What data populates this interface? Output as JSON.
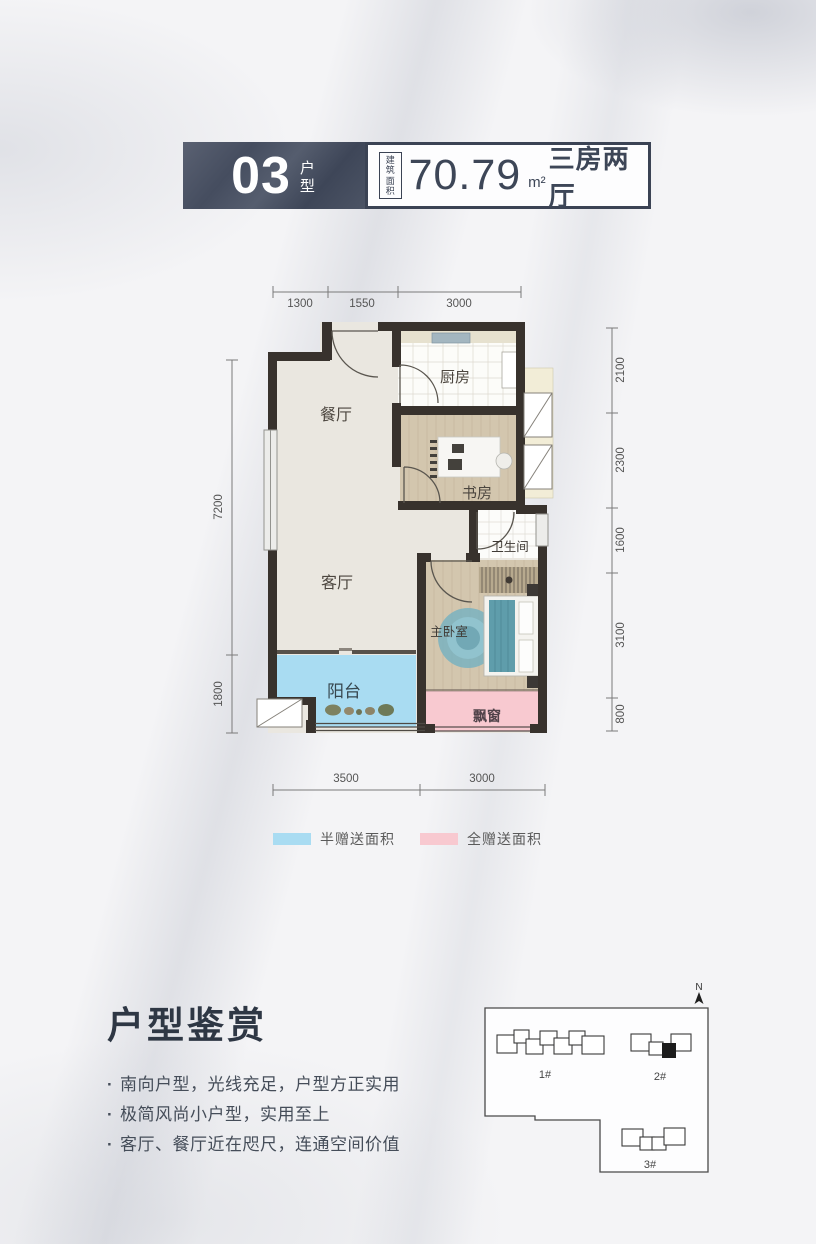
{
  "header": {
    "unit_number": "03",
    "unit_type": "户型",
    "area_label_1": "建筑",
    "area_label_2": "面积",
    "area_value": "70.79",
    "area_unit": "m²",
    "layout_type": "三房两厅"
  },
  "floorplan": {
    "rooms": {
      "dining": "餐厅",
      "kitchen": "厨房",
      "study": "书房",
      "bathroom": "卫生间",
      "living": "客厅",
      "master_bedroom": "主卧室",
      "balcony": "阳台",
      "bay_window": "飘窗"
    },
    "dims_top": [
      "1300",
      "1550",
      "3000"
    ],
    "dims_bottom": [
      "3500",
      "3000"
    ],
    "dims_left": [
      "7200",
      "1800"
    ],
    "dims_right": [
      "2100",
      "2300",
      "1600",
      "3100",
      "800"
    ],
    "colors": {
      "half_gift": "#a9dcf2",
      "full_gift": "#f8c9d0",
      "wall": "#38322d",
      "header_dark": "#4a5263",
      "text_dark": "#3d4657"
    }
  },
  "legend": {
    "half_gift": "半赠送面积",
    "full_gift": "全赠送面积"
  },
  "appreciation": {
    "title": "户型鉴赏",
    "bullet_marker": "·",
    "bullets": [
      "南向户型，光线充足，户型方正实用",
      "极简风尚小户型，实用至上",
      "客厅、餐厅近在咫尺，连通空间价值"
    ]
  },
  "siteplan": {
    "north": "N",
    "buildings": [
      "1#",
      "2#",
      "3#"
    ]
  }
}
